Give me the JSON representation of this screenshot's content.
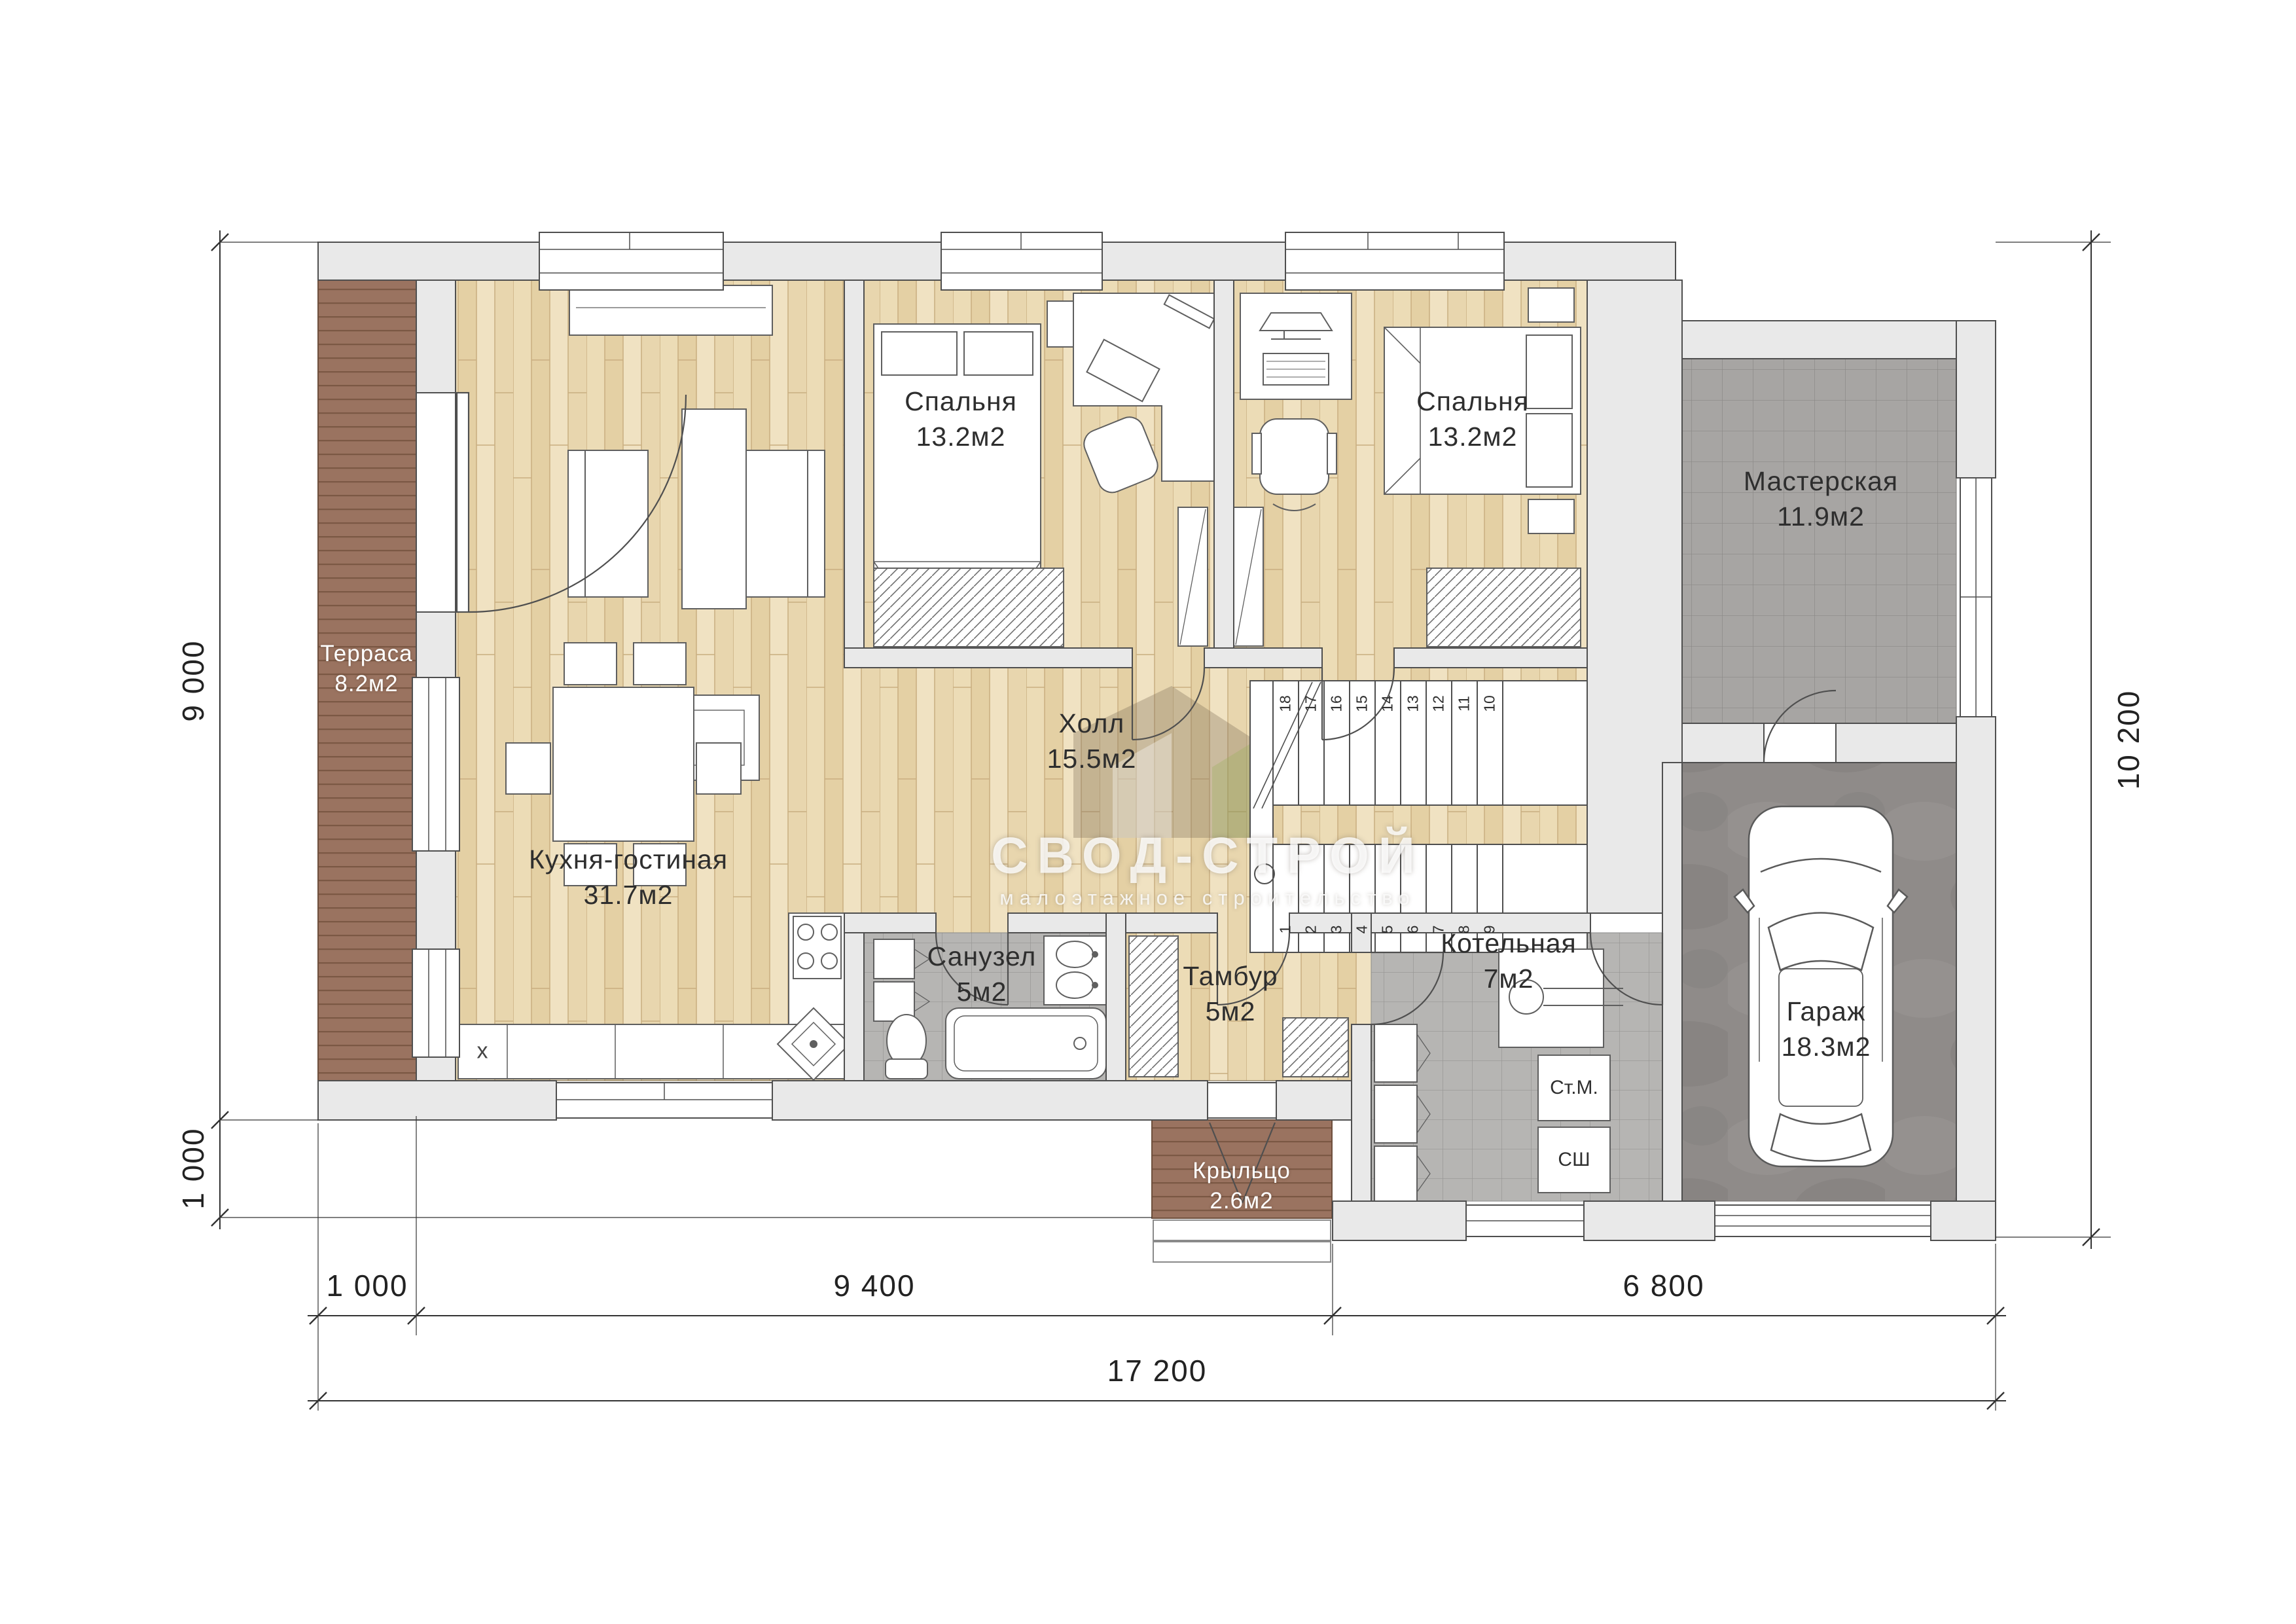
{
  "plan_title": "one-storey house floor plan",
  "rooms": {
    "terrace": {
      "name": "Терраса",
      "area": "8.2м2"
    },
    "kitchen_living": {
      "name": "Кухня-гостиная",
      "area": "31.7м2"
    },
    "bedroom_1": {
      "name": "Спальня",
      "area": "13.2м2"
    },
    "bedroom_2": {
      "name": "Спальня",
      "area": "13.2м2"
    },
    "workshop": {
      "name": "Мастерская",
      "area": "11.9м2"
    },
    "hall": {
      "name": "Холл",
      "area": "15.5м2"
    },
    "bathroom": {
      "name": "Санузел",
      "area": "5м2"
    },
    "vestibule": {
      "name": "Тамбур",
      "area": "5м2"
    },
    "boiler_room": {
      "name": "Котельная",
      "area": "7м2"
    },
    "garage": {
      "name": "Гараж",
      "area": "18.3м2"
    },
    "porch": {
      "name": "Крыльцо",
      "area": "2.6м2"
    }
  },
  "dimensions": {
    "left_height": "9 000",
    "left_porch": "1 000",
    "right_height": "10 200",
    "bottom_terrace": "1 000",
    "bottom_house": "9 400",
    "bottom_garage": "6 800",
    "bottom_total": "17 200"
  },
  "stairs": {
    "upper": [
      "18",
      "17",
      "16",
      "15",
      "14",
      "13",
      "12",
      "11",
      "10"
    ],
    "lower": [
      "1",
      "2",
      "3",
      "4",
      "5",
      "6",
      "7",
      "8",
      "9"
    ]
  },
  "appliances": {
    "washer": "Ст.М.",
    "dryer": "СШ",
    "kitchen_unit": "x"
  },
  "watermark": {
    "brand": "СВОД-СТРОЙ",
    "tagline": "малоэтажное строительство"
  },
  "palette": {
    "wood": "#e8d6ae",
    "deck": "#9a7360",
    "tile_bath": "#b6b5b3",
    "tile_workshop": "#a7a5a3",
    "concrete": "#8f8b89",
    "wall_fill": "#e9e9e9",
    "line": "#4f4f4f"
  }
}
